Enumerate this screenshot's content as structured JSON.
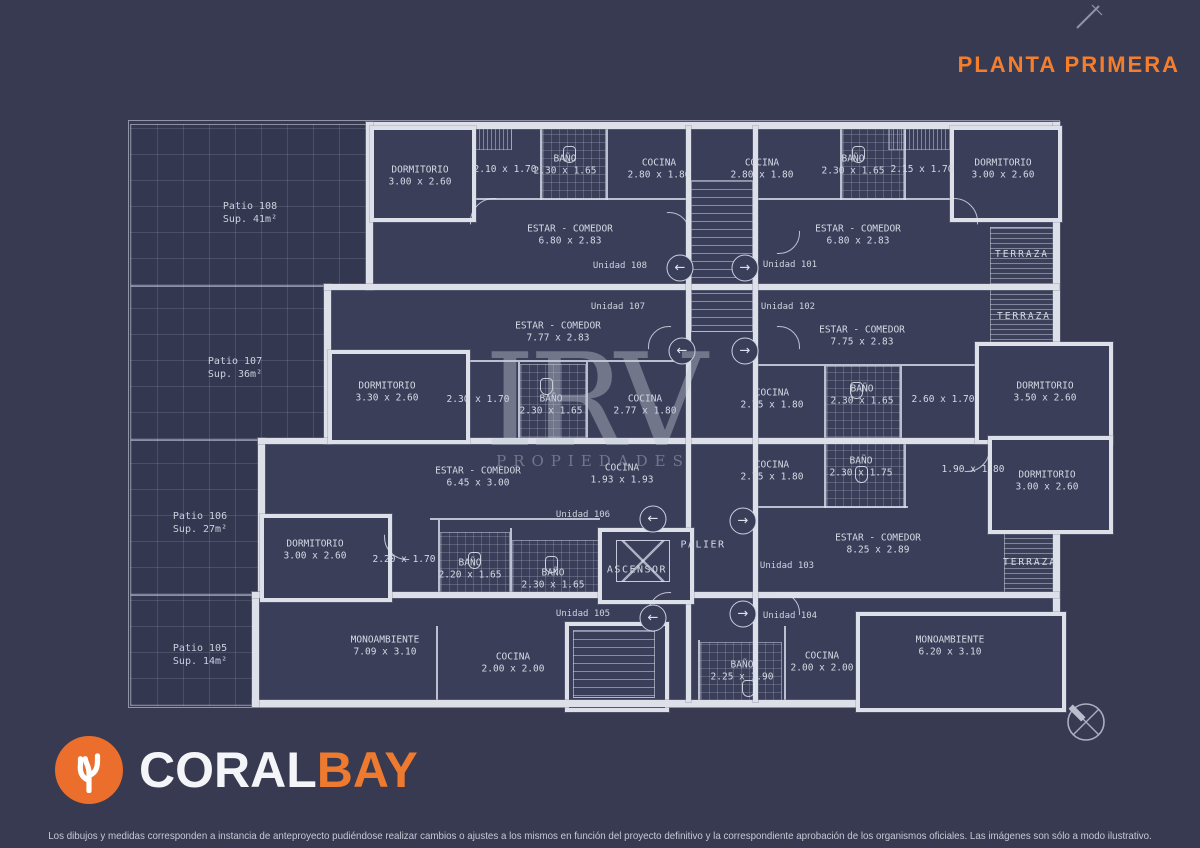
{
  "header": {
    "title": "PLANTA PRIMERA"
  },
  "watermark": {
    "line1": "IRV",
    "line2": "PROPIEDADES"
  },
  "logo": {
    "part1": "CORAL",
    "part2": "BAY"
  },
  "footer": {
    "disclaimer": "Los dibujos y medidas corresponden a instancia de anteproyecto pudiéndose realizar cambios o ajustes a los mismos en función del proyecto definitivo y la correspondiente aprobación de los organismos oficiales. Las imágenes son sólo a modo ilustrativo."
  },
  "colors": {
    "accent": "#f57e2c",
    "background": "#373a51",
    "plan_lines": "#dde0e9",
    "logo_orange": "#eb6e2d"
  },
  "plan": {
    "labels": [
      {
        "type": "patio",
        "lines": [
          "Patio 108",
          "Sup. 41m²"
        ],
        "x": 250,
        "y": 213
      },
      {
        "type": "patio",
        "lines": [
          "Patio 107",
          "Sup. 36m²"
        ],
        "x": 235,
        "y": 368
      },
      {
        "type": "patio",
        "lines": [
          "Patio 106",
          "Sup. 27m²"
        ],
        "x": 200,
        "y": 523
      },
      {
        "type": "patio",
        "lines": [
          "Patio 105",
          "Sup. 14m²"
        ],
        "x": 200,
        "y": 655
      },
      {
        "type": "room",
        "lines": [
          "DORMITORIO",
          "3.00 x 2.60"
        ],
        "x": 420,
        "y": 177
      },
      {
        "type": "dim",
        "lines": [
          "2.10 x 1.70"
        ],
        "x": 505,
        "y": 170
      },
      {
        "type": "room",
        "lines": [
          "BAÑO",
          "2.30 x 1.65"
        ],
        "x": 565,
        "y": 166
      },
      {
        "type": "room",
        "lines": [
          "COCINA",
          "2.80 x 1.80"
        ],
        "x": 659,
        "y": 170
      },
      {
        "type": "room",
        "lines": [
          "ESTAR - COMEDOR",
          "6.80 x 2.83"
        ],
        "x": 570,
        "y": 236
      },
      {
        "type": "unit",
        "lines": [
          "Unidad 108"
        ],
        "x": 620,
        "y": 267
      },
      {
        "type": "room",
        "lines": [
          "COCINA",
          "2.80 x 1.80"
        ],
        "x": 762,
        "y": 170
      },
      {
        "type": "room",
        "lines": [
          "BAÑO",
          "2.30 x 1.65"
        ],
        "x": 853,
        "y": 166
      },
      {
        "type": "dim",
        "lines": [
          "2.15 x 1.70"
        ],
        "x": 922,
        "y": 170
      },
      {
        "type": "room",
        "lines": [
          "DORMITORIO",
          "3.00 x 2.60"
        ],
        "x": 1003,
        "y": 170
      },
      {
        "type": "room",
        "lines": [
          "ESTAR - COMEDOR",
          "6.80 x 2.83"
        ],
        "x": 858,
        "y": 236
      },
      {
        "type": "unit",
        "lines": [
          "Unidad 101"
        ],
        "x": 790,
        "y": 266
      },
      {
        "type": "terraza",
        "lines": [
          "TERRAZA"
        ],
        "x": 1022,
        "y": 255
      },
      {
        "type": "unit",
        "lines": [
          "Unidad 107"
        ],
        "x": 618,
        "y": 308
      },
      {
        "type": "room",
        "lines": [
          "ESTAR - COMEDOR",
          "7.77 x 2.83"
        ],
        "x": 558,
        "y": 333
      },
      {
        "type": "room",
        "lines": [
          "DORMITORIO",
          "3.30 x 2.60"
        ],
        "x": 387,
        "y": 393
      },
      {
        "type": "dim",
        "lines": [
          "2.30 x 1.70"
        ],
        "x": 478,
        "y": 400
      },
      {
        "type": "room",
        "lines": [
          "BAÑO",
          "2.30 x 1.65"
        ],
        "x": 551,
        "y": 406
      },
      {
        "type": "room",
        "lines": [
          "COCINA",
          "2.77 x 1.80"
        ],
        "x": 645,
        "y": 406
      },
      {
        "type": "unit",
        "lines": [
          "Unidad 102"
        ],
        "x": 788,
        "y": 308
      },
      {
        "type": "room",
        "lines": [
          "ESTAR - COMEDOR",
          "7.75 x 2.83"
        ],
        "x": 862,
        "y": 337
      },
      {
        "type": "terraza",
        "lines": [
          "TERRAZA"
        ],
        "x": 1024,
        "y": 317
      },
      {
        "type": "room",
        "lines": [
          "COCINA",
          "2.75 x 1.80"
        ],
        "x": 772,
        "y": 400
      },
      {
        "type": "room",
        "lines": [
          "BAÑO",
          "2.30 x 1.65"
        ],
        "x": 862,
        "y": 396
      },
      {
        "type": "dim",
        "lines": [
          "2.60 x 1.70"
        ],
        "x": 943,
        "y": 400
      },
      {
        "type": "room",
        "lines": [
          "DORMITORIO",
          "3.50 x 2.60"
        ],
        "x": 1045,
        "y": 393
      },
      {
        "type": "room",
        "lines": [
          "ESTAR - COMEDOR",
          "6.45 x 3.00"
        ],
        "x": 478,
        "y": 478
      },
      {
        "type": "room",
        "lines": [
          "COCINA",
          "1.93 x 1.93"
        ],
        "x": 622,
        "y": 475
      },
      {
        "type": "unit",
        "lines": [
          "Unidad 106"
        ],
        "x": 583,
        "y": 516
      },
      {
        "type": "room",
        "lines": [
          "DORMITORIO",
          "3.00 x 2.60"
        ],
        "x": 315,
        "y": 551
      },
      {
        "type": "dim",
        "lines": [
          "2.20 x 1.70"
        ],
        "x": 404,
        "y": 560
      },
      {
        "type": "room",
        "lines": [
          "BAÑO",
          "2.20 x 1.65"
        ],
        "x": 470,
        "y": 570
      },
      {
        "type": "room",
        "lines": [
          "BAÑO",
          "2.30 x 1.65"
        ],
        "x": 553,
        "y": 580
      },
      {
        "type": "core",
        "lines": [
          "ASCENSOR"
        ],
        "x": 637,
        "y": 570
      },
      {
        "type": "core",
        "lines": [
          "PALIER"
        ],
        "x": 703,
        "y": 545
      },
      {
        "type": "room",
        "lines": [
          "COCINA",
          "2.75 x 1.80"
        ],
        "x": 772,
        "y": 472
      },
      {
        "type": "room",
        "lines": [
          "BAÑO",
          "2.30 x 1.75"
        ],
        "x": 861,
        "y": 468
      },
      {
        "type": "dim",
        "lines": [
          "1.90 x 1.80"
        ],
        "x": 973,
        "y": 470
      },
      {
        "type": "room",
        "lines": [
          "DORMITORIO",
          "3.00 x 2.60"
        ],
        "x": 1047,
        "y": 482
      },
      {
        "type": "room",
        "lines": [
          "ESTAR - COMEDOR",
          "8.25 x 2.89"
        ],
        "x": 878,
        "y": 545
      },
      {
        "type": "unit",
        "lines": [
          "Unidad 103"
        ],
        "x": 787,
        "y": 567
      },
      {
        "type": "terraza",
        "lines": [
          "TERRAZA"
        ],
        "x": 1030,
        "y": 563
      },
      {
        "type": "unit",
        "lines": [
          "Unidad 105"
        ],
        "x": 583,
        "y": 615
      },
      {
        "type": "unit",
        "lines": [
          "Unidad 104"
        ],
        "x": 790,
        "y": 617
      },
      {
        "type": "room",
        "lines": [
          "MONOAMBIENTE",
          "7.09 x 3.10"
        ],
        "x": 385,
        "y": 647
      },
      {
        "type": "room",
        "lines": [
          "COCINA",
          "2.00 x 2.00"
        ],
        "x": 513,
        "y": 664
      },
      {
        "type": "room",
        "lines": [
          "BAÑO",
          "2.25 x 1.90"
        ],
        "x": 742,
        "y": 672
      },
      {
        "type": "room",
        "lines": [
          "COCINA",
          "2.00 x 2.00"
        ],
        "x": 822,
        "y": 663
      },
      {
        "type": "room",
        "lines": [
          "MONOAMBIENTE",
          "6.20 x 3.10"
        ],
        "x": 950,
        "y": 647
      }
    ],
    "entries": [
      {
        "x": 680,
        "y": 268,
        "glyph": "←"
      },
      {
        "x": 745,
        "y": 268,
        "glyph": "→"
      },
      {
        "x": 682,
        "y": 351,
        "glyph": "←"
      },
      {
        "x": 745,
        "y": 351,
        "glyph": "→"
      },
      {
        "x": 653,
        "y": 519,
        "glyph": "←"
      },
      {
        "x": 743,
        "y": 521,
        "glyph": "→"
      },
      {
        "x": 653,
        "y": 618,
        "glyph": "←"
      },
      {
        "x": 743,
        "y": 614,
        "glyph": "→"
      }
    ]
  }
}
